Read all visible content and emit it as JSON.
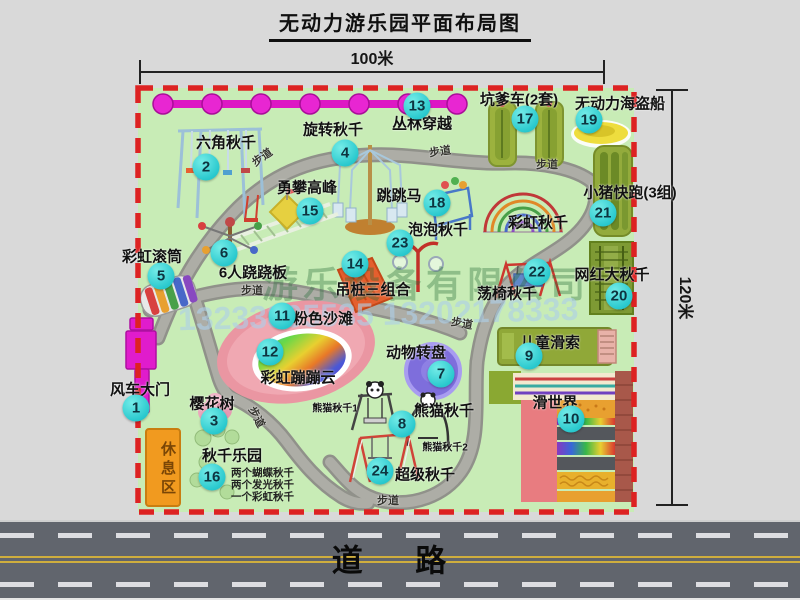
{
  "title": "无动力游乐园平面布局图",
  "dimensions": {
    "width": "100米",
    "height": "120米"
  },
  "road_label": "道 路",
  "rest_area_label": "休息区",
  "path_label": "步道",
  "watermark": {
    "company": "游乐设备有限公司",
    "phone": "13233805535 13202178333"
  },
  "extra_labels": {
    "rainbow_swing": "彩虹秋千",
    "panda_swing_1": "熊猫秋千1",
    "panda_swing_2": "熊猫秋千2"
  },
  "items": [
    {
      "num": "1",
      "label": "风车大门"
    },
    {
      "num": "2",
      "label": "六角秋千"
    },
    {
      "num": "3",
      "label": "樱花树"
    },
    {
      "num": "4",
      "label": "旋转秋千"
    },
    {
      "num": "5",
      "label": "彩虹滚筒"
    },
    {
      "num": "6",
      "label": "6人跷跷板"
    },
    {
      "num": "7",
      "label": "动物转盘"
    },
    {
      "num": "8",
      "label": "熊猫秋千"
    },
    {
      "num": "9",
      "label": "儿童滑索"
    },
    {
      "num": "10",
      "label": "滑世界"
    },
    {
      "num": "11",
      "label": "粉色沙滩"
    },
    {
      "num": "12",
      "label": "彩虹蹦蹦云"
    },
    {
      "num": "13",
      "label": "丛林穿越"
    },
    {
      "num": "14",
      "label": "吊桩三组合"
    },
    {
      "num": "15",
      "label": "勇攀高峰"
    },
    {
      "num": "16",
      "label": "秋千乐园",
      "sub": [
        "两个蝴蝶秋千",
        "两个发光秋千",
        "一个彩虹秋千"
      ]
    },
    {
      "num": "17",
      "label": "坑爹车(2套)"
    },
    {
      "num": "18",
      "label": "跳跳马"
    },
    {
      "num": "19",
      "label": "无动力海盗船"
    },
    {
      "num": "20",
      "label": "网红大秋千"
    },
    {
      "num": "21",
      "label": "小猪快跑(3组)"
    },
    {
      "num": "22",
      "label": "荡椅秋千"
    },
    {
      "num": "23",
      "label": "泡泡秋千"
    },
    {
      "num": "24",
      "label": "超级秋千"
    }
  ],
  "colors": {
    "park_green": "#c8ecb6",
    "border_red": "#dd2222",
    "badge_teal": "#2ac9ce",
    "path_gray": "#adada6",
    "magenta": "#e01ccc",
    "rest_orange": "#f19a1f",
    "road_gray": "#61656d",
    "beach_pink": "#ea96a2"
  }
}
